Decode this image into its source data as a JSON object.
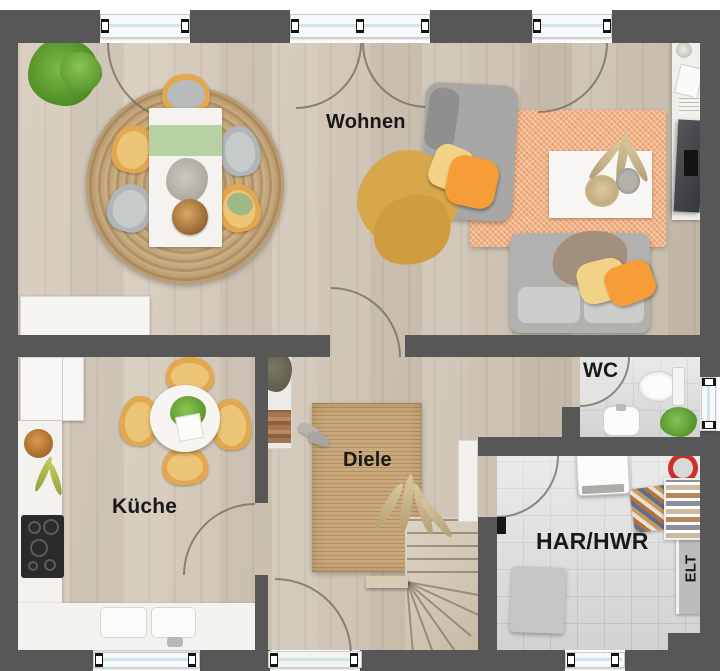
{
  "plan": {
    "kind": "apartment-floor-plan-top-view",
    "rooms": {
      "wohnen": {
        "label": "Wohnen"
      },
      "kueche": {
        "label": "Küche"
      },
      "diele": {
        "label": "Diele"
      },
      "wc": {
        "label": "WC"
      },
      "har_hwr": {
        "label": "HAR/HWR"
      },
      "elt": {
        "label": "ELT"
      }
    },
    "palette": {
      "wall": "#575757",
      "wood_floor": "#cfc3b2",
      "tile_floor": "#dddddd",
      "window_glass": "#cfe3ea",
      "jute_rug": "#bf9f74",
      "orange_rug": "#f3b184",
      "diele_rug": "#c9a97b",
      "chair_yellow": "#e2a850",
      "sofa_gray": "#aeaeac",
      "pillow_orange": "#f69d38",
      "pillow_yellow": "#f1d287",
      "plant_green": "#5f9c33",
      "mop_red": "#cd2f2a",
      "elt_panel": "#bcbcbc"
    }
  }
}
